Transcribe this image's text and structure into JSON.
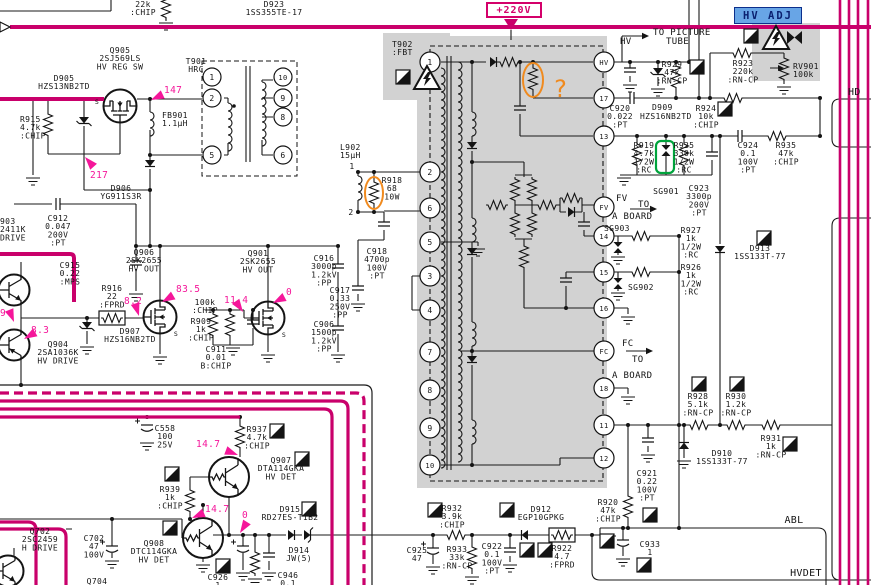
{
  "annotations": {
    "supply": "+220V",
    "hv_adj": "HV ADJ",
    "question_mark": "?"
  },
  "colors": {
    "bus": "#c9006b",
    "callout": "#f5169a",
    "shade": "#d2d2d2",
    "hv_adj_bg": "#68a5e6",
    "orange_note": "#f08a1e",
    "green_note": "#00a43c"
  },
  "fbt": {
    "designator": "T902",
    "part": ":FBT",
    "left_pins": [
      {
        "label": "1",
        "y": 62
      },
      {
        "label": "2",
        "y": 172
      },
      {
        "label": "6",
        "y": 208
      },
      {
        "label": "5",
        "y": 242
      },
      {
        "label": "3",
        "y": 276
      },
      {
        "label": "4",
        "y": 310
      },
      {
        "label": "7",
        "y": 352
      },
      {
        "label": "8",
        "y": 390
      },
      {
        "label": "9",
        "y": 428
      },
      {
        "label": "10",
        "y": 465
      }
    ],
    "right_pins": [
      {
        "label": "HV",
        "y": 62
      },
      {
        "label": "17",
        "y": 98
      },
      {
        "label": "13",
        "y": 136
      },
      {
        "label": "FV",
        "y": 207
      },
      {
        "label": "14",
        "y": 236
      },
      {
        "label": "15",
        "y": 272
      },
      {
        "label": "16",
        "y": 308
      },
      {
        "label": "FC",
        "y": 351
      },
      {
        "label": "18",
        "y": 388
      },
      {
        "label": "11",
        "y": 425
      },
      {
        "label": "12",
        "y": 458
      }
    ]
  },
  "t901": {
    "designator": "T901",
    "part": "HRC",
    "left_pins": [
      {
        "label": "1",
        "y": 77
      },
      {
        "label": "2",
        "y": 98
      },
      {
        "label": "5",
        "y": 155
      }
    ],
    "right_pins": [
      {
        "label": "10",
        "y": 77
      },
      {
        "label": "9",
        "y": 98
      },
      {
        "label": "8",
        "y": 117
      },
      {
        "label": "6",
        "y": 155
      }
    ]
  },
  "labels": [
    {
      "id": "r-top",
      "x": 143,
      "a": "m",
      "y": 7,
      "lines": [
        "22k",
        ":CHIP"
      ]
    },
    {
      "id": "d923",
      "x": 274,
      "a": "m",
      "y": 7,
      "lines": [
        "D923",
        "1SS355TE-17"
      ]
    },
    {
      "id": "t902",
      "x": 392,
      "a": "s",
      "y": 47,
      "lines": [
        "T902",
        ":FBT"
      ]
    },
    {
      "id": "t901",
      "x": 196,
      "a": "m",
      "y": 64,
      "lines": [
        "T901",
        "HRC"
      ]
    },
    {
      "id": "q905",
      "x": 120,
      "a": "m",
      "y": 53,
      "lines": [
        "Q905",
        "2SJ569LS",
        "HV REG SW"
      ]
    },
    {
      "id": "q905-s",
      "x": 97,
      "a": "m",
      "y": 104,
      "s": 6.5,
      "lines": [
        "S"
      ]
    },
    {
      "id": "d905",
      "x": 64,
      "a": "m",
      "y": 81,
      "lines": [
        "D905",
        "HZS13NB2TD"
      ]
    },
    {
      "id": "r915",
      "x": 20,
      "a": "s",
      "y": 122,
      "lines": [
        "R915",
        "4.7k",
        ":CHIP"
      ]
    },
    {
      "id": "fb901",
      "x": 162,
      "a": "s",
      "y": 118,
      "lines": [
        "FB901",
        "1.1μH"
      ]
    },
    {
      "id": "d906",
      "x": 121,
      "a": "m",
      "y": 191,
      "lines": [
        "D906",
        "YG911S3R"
      ]
    },
    {
      "id": "q903",
      "x": 0,
      "a": "s",
      "y": 224,
      "lines": [
        "903",
        "2411K",
        "DRIVE"
      ]
    },
    {
      "id": "c912",
      "x": 58,
      "a": "m",
      "y": 221,
      "lines": [
        "C912",
        "0.047",
        "200V",
        ":PT"
      ]
    },
    {
      "id": "c915",
      "x": 70,
      "a": "m",
      "y": 268,
      "lines": [
        "C915",
        "0.22",
        ":MPS"
      ]
    },
    {
      "id": "q906",
      "x": 144,
      "a": "m",
      "y": 255,
      "lines": [
        "Q906",
        "2SK2655",
        "HV OUT"
      ]
    },
    {
      "id": "q906-s",
      "x": 176,
      "a": "m",
      "y": 336,
      "s": 6.5,
      "lines": [
        "S"
      ]
    },
    {
      "id": "r916",
      "x": 112,
      "a": "m",
      "y": 291,
      "lines": [
        "R916",
        "22",
        ":FPRD"
      ]
    },
    {
      "id": "d907",
      "x": 130,
      "a": "m",
      "y": 334,
      "lines": [
        "D907",
        "HZS16NB2TD"
      ]
    },
    {
      "id": "q904",
      "x": 58,
      "a": "m",
      "y": 347,
      "lines": [
        "Q904",
        "2SA1036K",
        "HV DRIVE"
      ]
    },
    {
      "id": "r-100k",
      "x": 205,
      "a": "m",
      "y": 305,
      "lines": [
        "100k",
        ":CHIP"
      ]
    },
    {
      "id": "r909",
      "x": 201,
      "a": "m",
      "y": 324,
      "lines": [
        "R909",
        "1k",
        ":CHIP"
      ]
    },
    {
      "id": "c911",
      "x": 216,
      "a": "m",
      "y": 352,
      "lines": [
        "C911",
        "0.01",
        "B:CHIP"
      ]
    },
    {
      "id": "q901",
      "x": 258,
      "a": "m",
      "y": 256,
      "lines": [
        "Q901",
        "2SK2655",
        "HV OUT"
      ]
    },
    {
      "id": "q901-s",
      "x": 284,
      "a": "m",
      "y": 337,
      "s": 6.5,
      "lines": [
        "S"
      ]
    },
    {
      "id": "c916",
      "x": 324,
      "a": "m",
      "y": 261,
      "lines": [
        "C916",
        "3000p",
        "1.2kV",
        ":PP"
      ]
    },
    {
      "id": "c906",
      "x": 324,
      "a": "m",
      "y": 327,
      "lines": [
        "C906",
        "1500p",
        "1.2kV",
        ":PP"
      ]
    },
    {
      "id": "l902",
      "x": 340,
      "a": "s",
      "y": 150,
      "lines": [
        "L902",
        "15μH"
      ]
    },
    {
      "id": "l902-p1",
      "x": 352,
      "a": "m",
      "y": 169,
      "lines": [
        "1"
      ]
    },
    {
      "id": "l902-p2",
      "x": 351,
      "a": "m",
      "y": 215,
      "lines": [
        "2"
      ]
    },
    {
      "id": "r918",
      "x": 392,
      "a": "m",
      "y": 183,
      "lines": [
        "R918",
        "68",
        "10W"
      ]
    },
    {
      "id": "c918",
      "x": 377,
      "a": "m",
      "y": 254,
      "lines": [
        "C918",
        "4700p",
        "100V",
        ":PT"
      ]
    },
    {
      "id": "c917",
      "x": 340,
      "a": "m",
      "y": 293,
      "lines": [
        "C917",
        "0.33",
        "250V",
        ":PP"
      ]
    },
    {
      "id": "tube1",
      "x": 653,
      "a": "s",
      "y": 35,
      "s": 9,
      "lines": [
        "TO PICTURE"
      ]
    },
    {
      "id": "tube2",
      "x": 666,
      "a": "s",
      "y": 44,
      "s": 9,
      "lines": [
        "TUBE"
      ]
    },
    {
      "id": "hv-net",
      "x": 620,
      "a": "s",
      "y": 44,
      "s": 9,
      "lines": [
        "HV"
      ]
    },
    {
      "id": "r929",
      "x": 672,
      "a": "m",
      "y": 67,
      "lines": [
        "R929",
        "47k",
        ":RN-CP"
      ]
    },
    {
      "id": "c920",
      "x": 620,
      "a": "m",
      "y": 111,
      "lines": [
        "C920",
        "0.022",
        ":PT"
      ]
    },
    {
      "id": "d909",
      "x": 652,
      "a": "s",
      "y": 110,
      "lines": [
        "D909"
      ]
    },
    {
      "id": "d909b",
      "x": 640,
      "a": "s",
      "y": 119,
      "lines": [
        "HZS16NB2TD"
      ]
    },
    {
      "id": "r923",
      "x": 743,
      "a": "m",
      "y": 66,
      "lines": [
        "R923",
        "220k",
        ":RN-CP"
      ]
    },
    {
      "id": "rv901",
      "x": 793,
      "a": "s",
      "y": 69,
      "lines": [
        "RV901",
        "100k"
      ]
    },
    {
      "id": "r924",
      "x": 706,
      "a": "m",
      "y": 111,
      "lines": [
        "R924",
        "10k",
        ":CHIP"
      ]
    },
    {
      "id": "hd-net",
      "x": 848,
      "a": "s",
      "y": 95,
      "s": 10,
      "lines": [
        "HD"
      ]
    },
    {
      "id": "r919",
      "x": 644,
      "a": "m",
      "y": 148,
      "lines": [
        "R919",
        "4.7k",
        "1/2W",
        ":RC"
      ]
    },
    {
      "id": "r925",
      "x": 684,
      "a": "m",
      "y": 148,
      "lines": [
        "R925",
        "330k",
        "1/2W",
        ":RC"
      ]
    },
    {
      "id": "sg901",
      "x": 666,
      "a": "m",
      "y": 194,
      "lines": [
        "SG901"
      ]
    },
    {
      "id": "c923",
      "x": 699,
      "a": "m",
      "y": 191,
      "lines": [
        "C923",
        "3300p",
        "200V",
        ":PT"
      ]
    },
    {
      "id": "c924",
      "x": 748,
      "a": "m",
      "y": 148,
      "lines": [
        "C924",
        "0.1",
        "100V",
        ":PT"
      ]
    },
    {
      "id": "r935",
      "x": 786,
      "a": "m",
      "y": 148,
      "lines": [
        "R935",
        "47k",
        ":CHIP"
      ]
    },
    {
      "id": "fv-net",
      "x": 616,
      "a": "s",
      "y": 201,
      "s": 9,
      "lines": [
        "FV"
      ]
    },
    {
      "id": "to-board1a",
      "x": 638,
      "a": "s",
      "y": 207,
      "s": 9,
      "lines": [
        "TO"
      ]
    },
    {
      "id": "to-board1b",
      "x": 612,
      "a": "s",
      "y": 219,
      "s": 9,
      "lines": [
        "A BOARD"
      ]
    },
    {
      "id": "sg903",
      "x": 604,
      "a": "s",
      "y": 231,
      "lines": [
        "SG903"
      ]
    },
    {
      "id": "r927",
      "x": 691,
      "a": "m",
      "y": 233,
      "lines": [
        "R927",
        "1k",
        "1/2W",
        ":RC"
      ]
    },
    {
      "id": "r926",
      "x": 691,
      "a": "m",
      "y": 270,
      "lines": [
        "R926",
        "1k",
        "1/2W",
        ":RC"
      ]
    },
    {
      "id": "d913",
      "x": 760,
      "a": "m",
      "y": 251,
      "lines": [
        "D913",
        "1SS133T-77"
      ]
    },
    {
      "id": "sg902",
      "x": 628,
      "a": "s",
      "y": 290,
      "lines": [
        "SG902"
      ]
    },
    {
      "id": "fc-net",
      "x": 622,
      "a": "s",
      "y": 346,
      "s": 9,
      "lines": [
        "FC"
      ]
    },
    {
      "id": "to-board2a",
      "x": 632,
      "a": "s",
      "y": 362,
      "s": 9,
      "lines": [
        "TO"
      ]
    },
    {
      "id": "to-board2b",
      "x": 612,
      "a": "s",
      "y": 378,
      "s": 9,
      "lines": [
        "A BOARD"
      ]
    },
    {
      "id": "r928",
      "x": 698,
      "a": "m",
      "y": 399,
      "lines": [
        "R928",
        "5.1k",
        ":RN-CP"
      ]
    },
    {
      "id": "r930",
      "x": 736,
      "a": "m",
      "y": 399,
      "lines": [
        "R930",
        "1.2k",
        ":RN-CP"
      ]
    },
    {
      "id": "r931",
      "x": 771,
      "a": "m",
      "y": 441,
      "lines": [
        "R931",
        "1k",
        ":RN-CP"
      ]
    },
    {
      "id": "d910",
      "x": 722,
      "a": "m",
      "y": 456,
      "lines": [
        "D910",
        "1SS133T-77"
      ]
    },
    {
      "id": "c921",
      "x": 647,
      "a": "m",
      "y": 476,
      "lines": [
        "C921",
        "0.22",
        "100V",
        ":PT"
      ]
    },
    {
      "id": "r920",
      "x": 608,
      "a": "m",
      "y": 505,
      "lines": [
        "R920",
        "47k",
        ":CHIP"
      ]
    },
    {
      "id": "c933",
      "x": 650,
      "a": "m",
      "y": 547,
      "lines": [
        "C933",
        "1"
      ]
    },
    {
      "id": "abl-net",
      "x": 794,
      "a": "m",
      "y": 523,
      "s": 10,
      "lines": [
        "ABL"
      ]
    },
    {
      "id": "hvdet-net",
      "x": 806,
      "a": "m",
      "y": 576,
      "s": 10,
      "lines": [
        "HVDET"
      ]
    },
    {
      "id": "r932",
      "x": 452,
      "a": "m",
      "y": 511,
      "lines": [
        "R932",
        "3.9k",
        ":CHIP"
      ]
    },
    {
      "id": "d912",
      "x": 541,
      "a": "m",
      "y": 512,
      "lines": [
        "D912",
        "EGP10GPKG"
      ]
    },
    {
      "id": "c922",
      "x": 492,
      "a": "m",
      "y": 549,
      "lines": [
        "C922",
        "0.1",
        "100V",
        ":PT"
      ]
    },
    {
      "id": "r933",
      "x": 457,
      "a": "m",
      "y": 552,
      "lines": [
        "R933",
        "33k",
        ":RN-CP"
      ]
    },
    {
      "id": "c925",
      "x": 417,
      "a": "m",
      "y": 553,
      "lines": [
        "C925",
        "47"
      ]
    },
    {
      "id": "r922",
      "x": 562,
      "a": "m",
      "y": 551,
      "lines": [
        "R922",
        "4.7",
        ":FPRD"
      ]
    },
    {
      "id": "d914",
      "x": 299,
      "a": "m",
      "y": 553,
      "lines": [
        "D914",
        "JW(5)"
      ]
    },
    {
      "id": "d915",
      "x": 290,
      "a": "m",
      "y": 512,
      "lines": [
        "D915",
        "RD27ES-T1B2"
      ]
    },
    {
      "id": "c926",
      "x": 218,
      "a": "m",
      "y": 580,
      "lines": [
        "C926",
        "1"
      ]
    },
    {
      "id": "c946",
      "x": 288,
      "a": "m",
      "y": 578,
      "lines": [
        "C946",
        "0.1"
      ]
    },
    {
      "id": "r937",
      "x": 257,
      "a": "m",
      "y": 432,
      "lines": [
        "R937",
        "4.7k",
        ":CHIP"
      ]
    },
    {
      "id": "c558",
      "x": 165,
      "a": "m",
      "y": 431,
      "lines": [
        "C558",
        "100",
        "25V"
      ]
    },
    {
      "id": "q907",
      "x": 281,
      "a": "m",
      "y": 463,
      "lines": [
        "Q907",
        "DTA114GKA",
        "HV DET"
      ]
    },
    {
      "id": "r939",
      "x": 170,
      "a": "m",
      "y": 492,
      "lines": [
        "R939",
        "1k",
        ":CHIP"
      ]
    },
    {
      "id": "q908",
      "x": 154,
      "a": "m",
      "y": 546,
      "lines": [
        "Q908",
        "DTC114GKA",
        "HV DET"
      ]
    },
    {
      "id": "q702",
      "x": 40,
      "a": "m",
      "y": 534,
      "lines": [
        "Q702",
        "2SC2459",
        "H DRIVE"
      ]
    },
    {
      "id": "c702",
      "x": 94,
      "a": "m",
      "y": 541,
      "lines": [
        "C702",
        "47",
        "100V"
      ]
    },
    {
      "id": "q704",
      "x": 97,
      "a": "m",
      "y": 584,
      "lines": [
        "Q704"
      ]
    },
    {
      "id": "query-annotation",
      "x": 553,
      "a": "s",
      "y": 97,
      "s": 24,
      "c": "#f08a1e",
      "lines": [
        "?"
      ]
    }
  ],
  "voltage_callouts": [
    {
      "v": "147",
      "x": 164,
      "y": 93,
      "tx": 151,
      "ty": 100
    },
    {
      "v": "217",
      "x": 90,
      "y": 178,
      "tx": 85,
      "ty": 157
    },
    {
      "v": "8.2",
      "x": 124,
      "y": 304,
      "tx": 139,
      "ty": 316
    },
    {
      "v": "83.5",
      "x": 176,
      "y": 292,
      "tx": 162,
      "ty": 302
    },
    {
      "v": "11.4",
      "x": 224,
      "y": 303,
      "tx": 243,
      "ty": 312
    },
    {
      "v": "0",
      "x": 286,
      "y": 295,
      "tx": 273,
      "ty": 303
    },
    {
      "v": "8.3",
      "x": 31,
      "y": 333,
      "tx": 24,
      "ty": 339
    },
    {
      "v": "9",
      "x": 0,
      "y": 316,
      "tx": 14,
      "ty": 322
    },
    {
      "v": "14.7",
      "x": 196,
      "y": 447,
      "tx": 238,
      "ty": 455
    },
    {
      "v": "14.7",
      "x": 205,
      "y": 512,
      "tx": 192,
      "ty": 518
    },
    {
      "v": "0",
      "x": 242,
      "y": 518,
      "tx": 240,
      "ty": 533
    }
  ],
  "flag_icons": [
    [
      396,
      70
    ],
    [
      690,
      60
    ],
    [
      718,
      102
    ],
    [
      744,
      29
    ],
    [
      757,
      231
    ],
    [
      692,
      377
    ],
    [
      730,
      377
    ],
    [
      783,
      437
    ],
    [
      643,
      508
    ],
    [
      637,
      558
    ],
    [
      600,
      534
    ],
    [
      428,
      503
    ],
    [
      500,
      503
    ],
    [
      520,
      543
    ],
    [
      538,
      543
    ],
    [
      302,
      502
    ],
    [
      216,
      559
    ],
    [
      270,
      424
    ],
    [
      165,
      467
    ],
    [
      295,
      452
    ],
    [
      163,
      521
    ]
  ],
  "warning_icons": [
    [
      427,
      78
    ],
    [
      776,
      38
    ]
  ],
  "bowtie_icons": [
    [
      787,
      31
    ]
  ]
}
